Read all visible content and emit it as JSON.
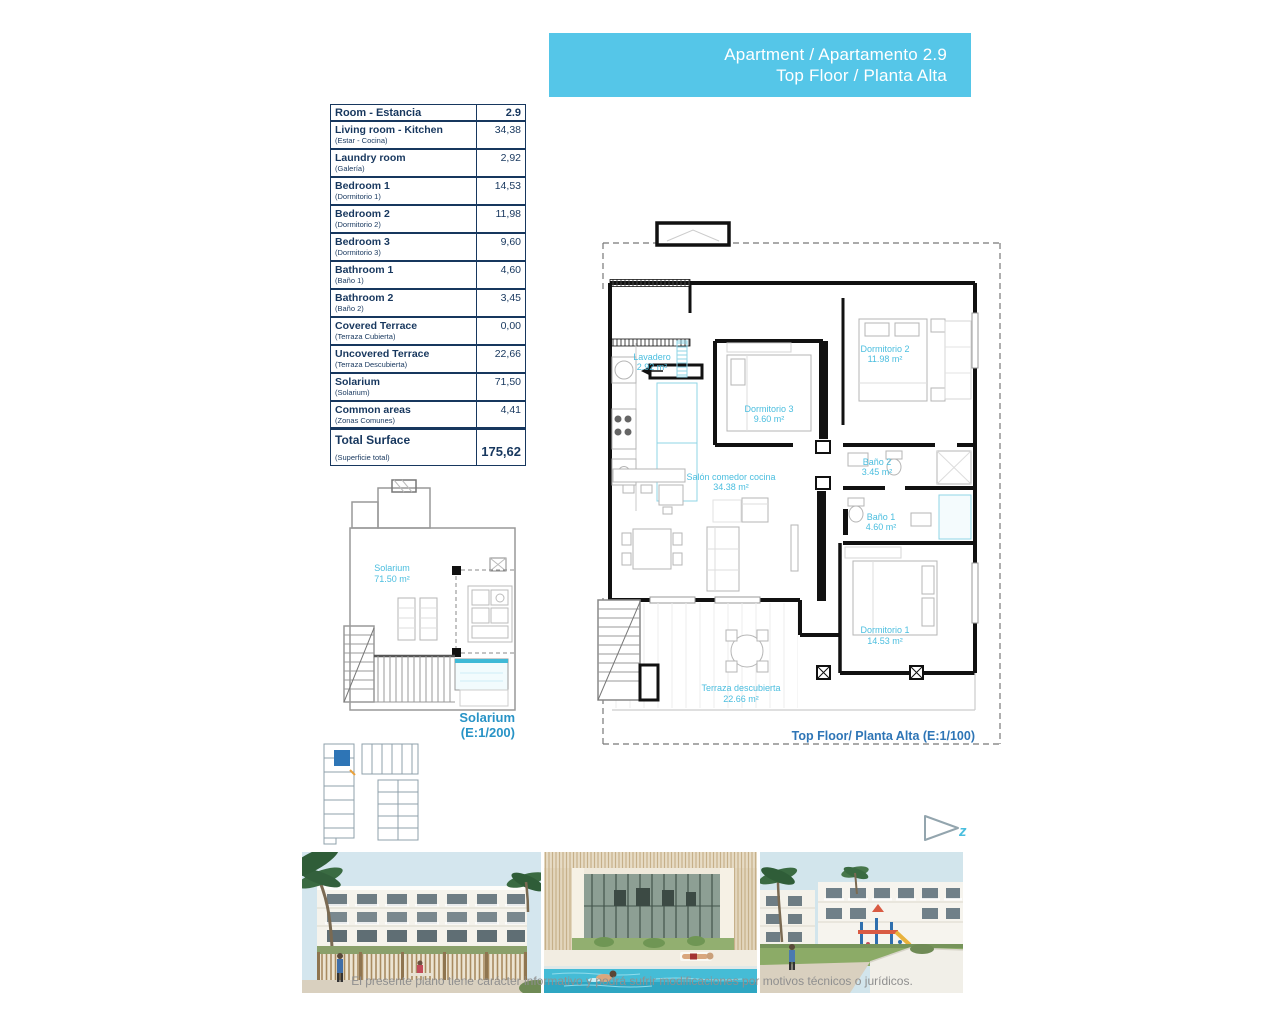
{
  "header": {
    "title_line1": "Apartment / Apartamento 2.9",
    "title_line2": "Top Floor / Planta Alta"
  },
  "area_table": {
    "header_label": "Room - Estancia",
    "header_value": "2.9",
    "rows": [
      {
        "en": "Living room - Kitchen",
        "es": "(Estar - Cocina)",
        "value": "34,38"
      },
      {
        "en": "Laundry room",
        "es": "(Galería)",
        "value": "2,92"
      },
      {
        "en": "Bedroom 1",
        "es": "(Dormitorio 1)",
        "value": "14,53"
      },
      {
        "en": "Bedroom 2",
        "es": "(Dormitorio 2)",
        "value": "11,98"
      },
      {
        "en": "Bedroom 3",
        "es": "(Dormitorio 3)",
        "value": "9,60"
      },
      {
        "en": "Bathroom 1",
        "es": "(Baño 1)",
        "value": "4,60"
      },
      {
        "en": "Bathroom 2",
        "es": "(Baño 2)",
        "value": "3,45"
      },
      {
        "en": "Covered Terrace",
        "es": "(Terraza Cubierta)",
        "value": "0,00"
      },
      {
        "en": "Uncovered Terrace",
        "es": "(Terraza Descubierta)",
        "value": "22,66"
      },
      {
        "en": "Solarium",
        "es": "(Solarium)",
        "value": "71,50"
      },
      {
        "en": "Common areas",
        "es": "(Zonas Comunes)",
        "value": "4,41"
      }
    ],
    "total": {
      "en": "Total Surface",
      "es": "(Superficie total)",
      "value": "175,62"
    }
  },
  "floor_plan": {
    "caption": "Top Floor/ Planta Alta (E:1/100)",
    "labels": {
      "lavadero": {
        "name": "Lavadero",
        "area": "2.92 m²"
      },
      "dormitorio3": {
        "name": "Dormitorio 3",
        "area": "9.60 m²"
      },
      "dormitorio2": {
        "name": "Dormitorio 2",
        "area": "11.98 m²"
      },
      "salon": {
        "name": "Salón comedor cocina",
        "area": "34.38 m²"
      },
      "bano2": {
        "name": "Baño 2",
        "area": "3.45 m²"
      },
      "bano1": {
        "name": "Baño 1",
        "area": "4.60 m²"
      },
      "dormitorio1": {
        "name": "Dormitorio 1",
        "area": "14.53 m²"
      },
      "terraza": {
        "name": "Terraza descubierta",
        "area": "22.66 m²"
      }
    }
  },
  "solarium_plan": {
    "label_name": "Solarium",
    "label_area": "71.50 m²",
    "caption_line1": "Solarium",
    "caption_line2": "(E:1/200)"
  },
  "logo": {
    "letter": "z"
  },
  "footer": {
    "disclaimer": "El presente plano tiene carácter informativo y podrá sufrir modificaciones por motivos técnicos o jurídicos."
  },
  "colors": {
    "banner_bg": "#55C6E8",
    "table_ink": "#17375E",
    "plan_label_cyan": "#4BBEDF",
    "plan_caption_blue": "#2E75B6",
    "solarium_caption_blue": "#2893C6"
  }
}
